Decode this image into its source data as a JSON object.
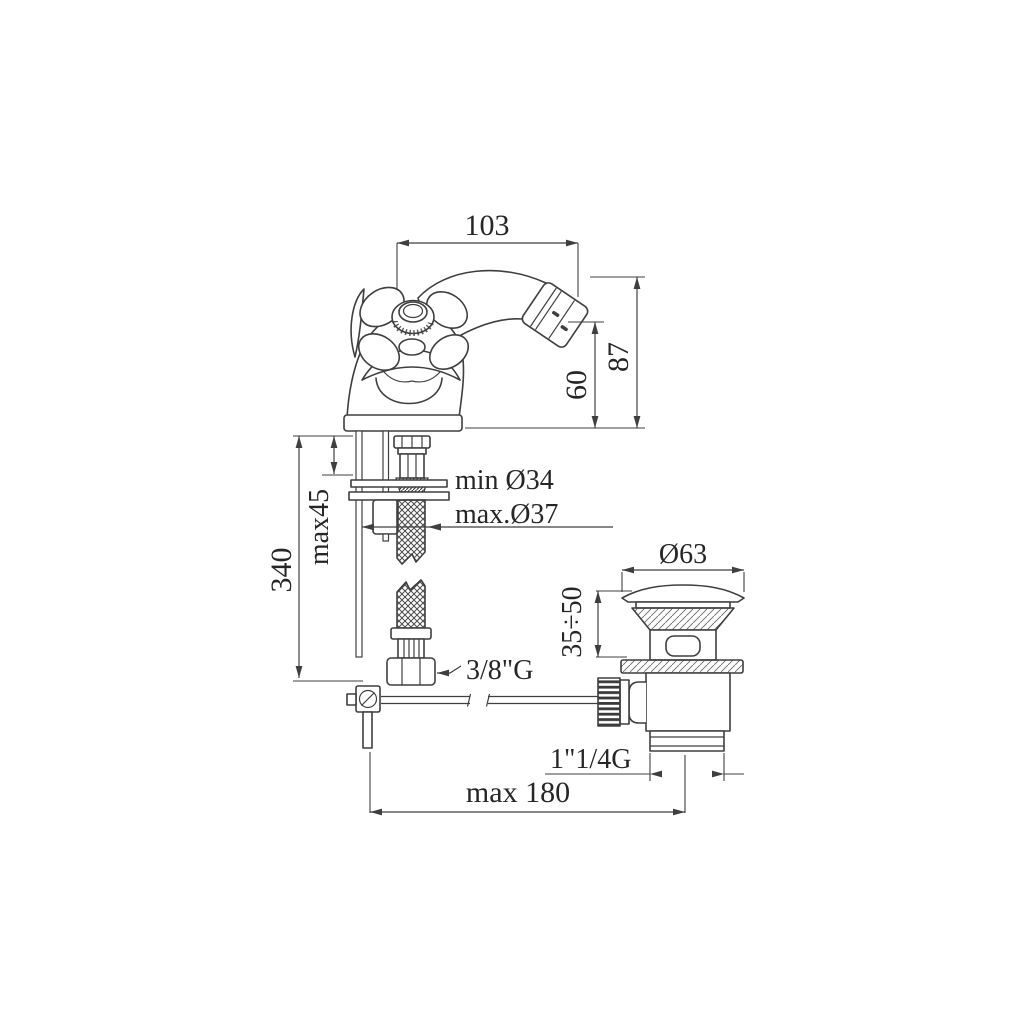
{
  "drawing": {
    "background": "#ffffff",
    "line_color": "#3f3f3f",
    "text_color": "#262626",
    "labels": {
      "spout_reach": "103",
      "spout_height": "87",
      "outlet_height": "60",
      "supply_length": "340",
      "deck_max": "max45",
      "hole_min": "min Ø34",
      "hole_max": "max.Ø37",
      "supply_thread": "3/8\"G",
      "waste_cap_dia": "Ø63",
      "waste_height_range": "35÷50",
      "waste_thread": "1\"1/4G",
      "rod_reach_max": "max 180"
    }
  }
}
